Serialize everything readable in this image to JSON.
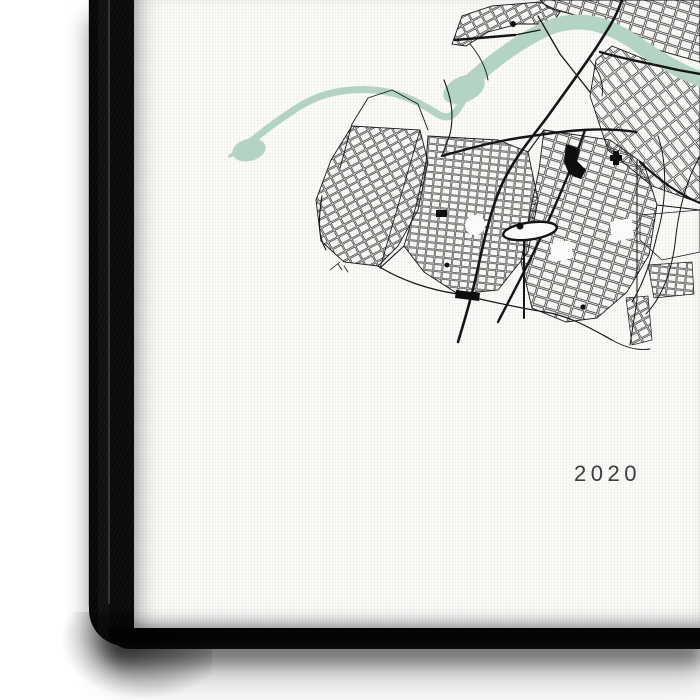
{
  "artwork": {
    "year_label": "2020"
  },
  "colors": {
    "background": "#ffffff",
    "canvas_face": "#fbfbf9",
    "canvas_edge": "#0a0a0a",
    "river": "#b3d3c5",
    "streets": "#151515",
    "landmarks": "#0e0e0e",
    "year_text": "#3e3e3e"
  }
}
